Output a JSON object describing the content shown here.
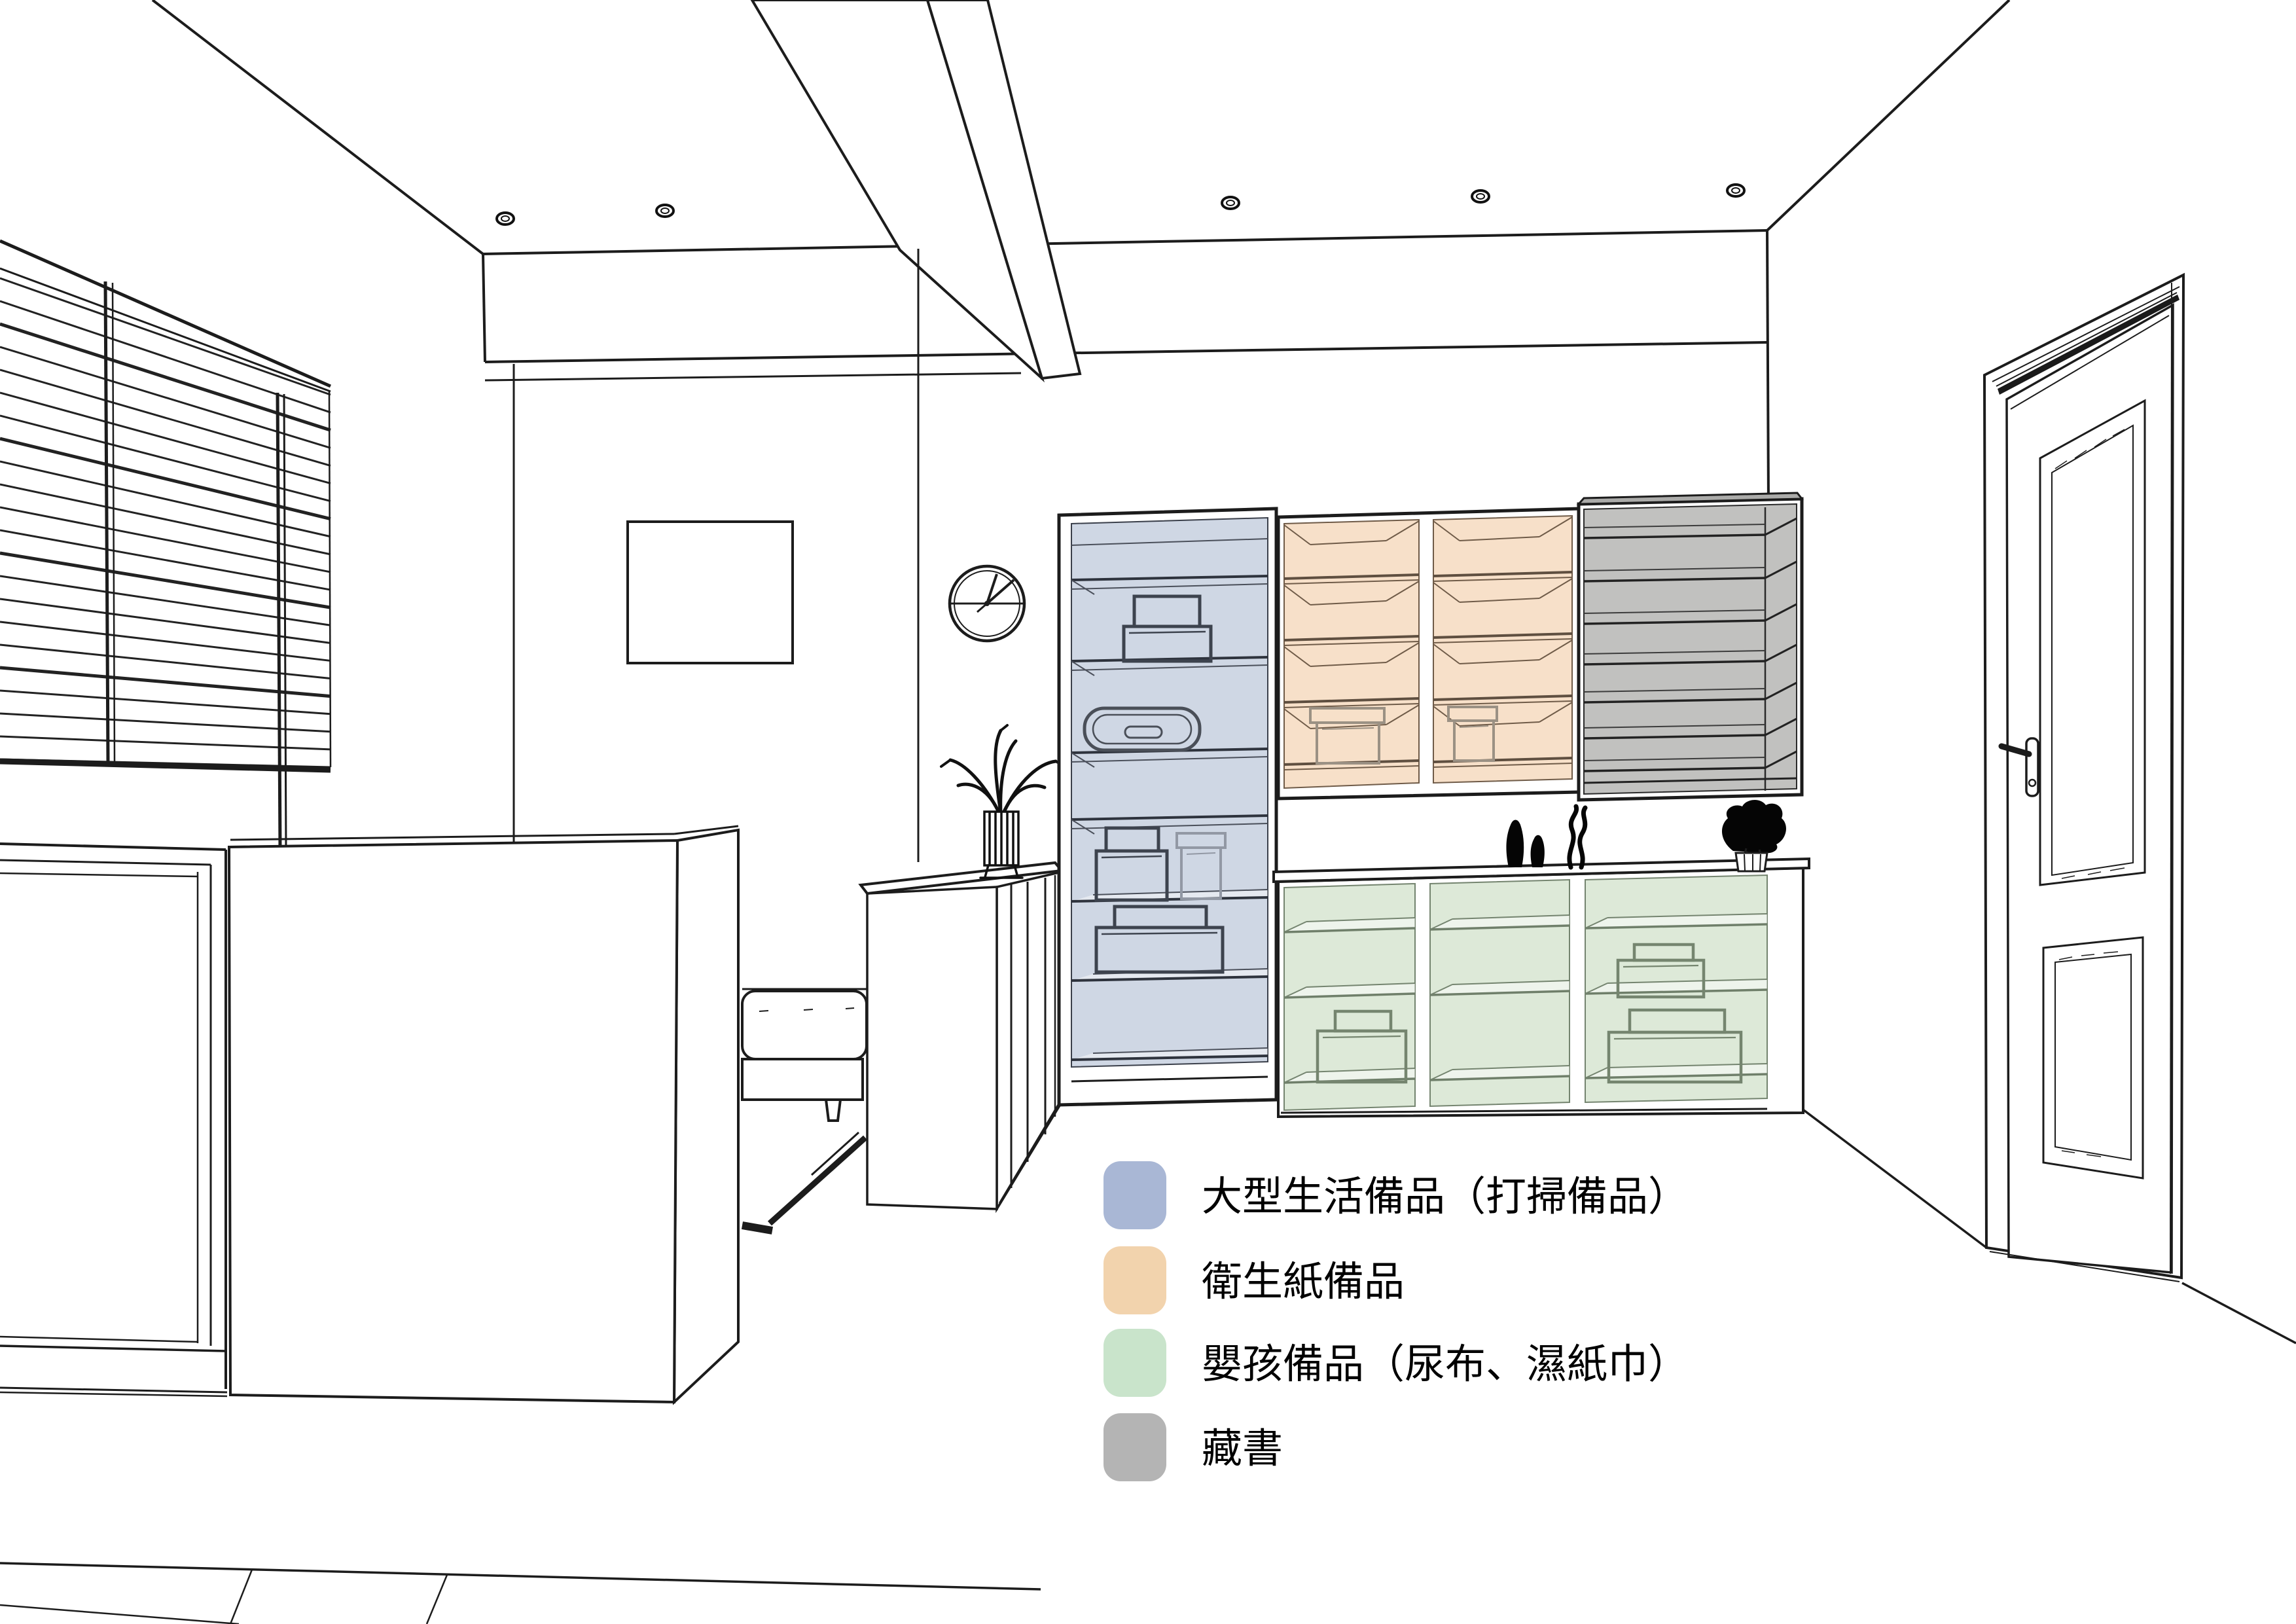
{
  "page": {
    "type": "interior-storage-plan-perspective",
    "background": "#ffffff",
    "line_color": "#1c1c1c"
  },
  "zones": {
    "large_living": {
      "name": "大型生活備品（打掃備品）",
      "fill": "#cfd7e4"
    },
    "toilet_paper": {
      "name": "衛生紙備品",
      "fill": "#f7e0c9"
    },
    "baby": {
      "name": "嬰孩備品（尿布、濕紙巾）",
      "fill": "#dde9d8"
    },
    "books": {
      "name": "藏書",
      "fill": "#c1c1bf"
    }
  },
  "legend": {
    "items": [
      {
        "key": "large-living-supplies",
        "swatch_color": "#a9b7d5",
        "label": "大型生活備品（打掃備品）"
      },
      {
        "key": "toilet-paper-supplies",
        "swatch_color": "#f2d3ad",
        "label": "衛生紙備品"
      },
      {
        "key": "baby-supplies",
        "swatch_color": "#c9e4cb",
        "label": "嬰孩備品（尿布、濕紙巾）"
      },
      {
        "key": "book-collection",
        "swatch_color": "#b4b4b4",
        "label": "藏書"
      }
    ]
  }
}
